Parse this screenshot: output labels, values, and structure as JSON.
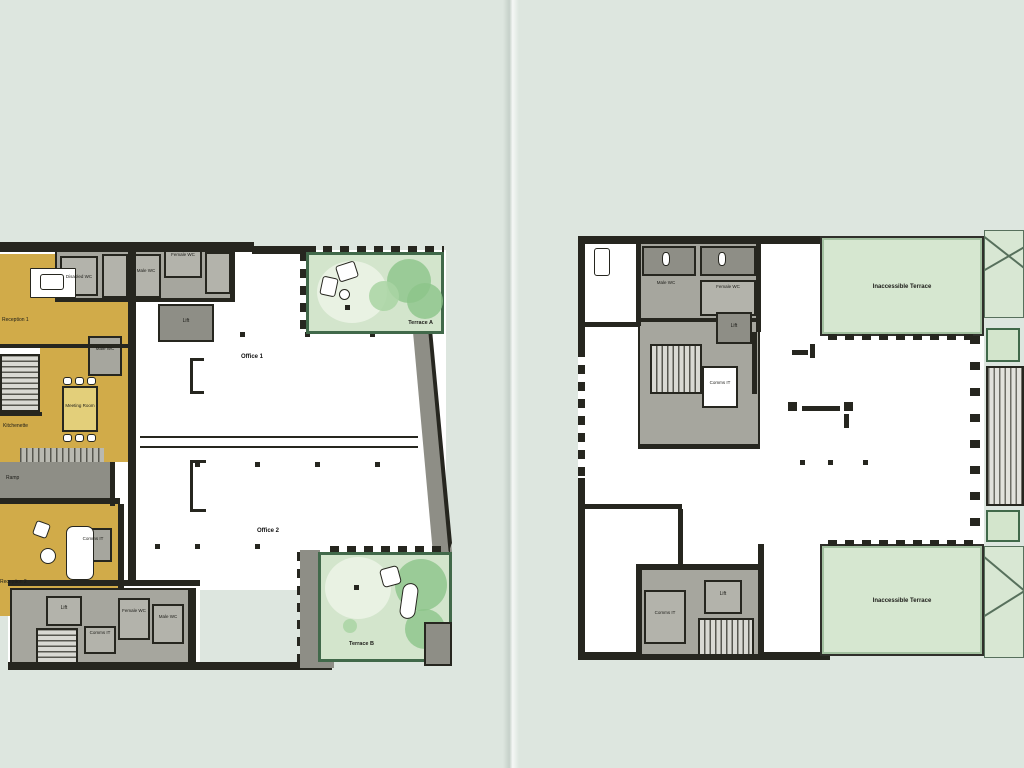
{
  "meta": {
    "description": "Two architectural floor plans side by side on a pale green background",
    "left_plan_name": "Lower floor plan",
    "right_plan_name": "Upper floor plan"
  },
  "colors": {
    "bg": "#dde6df",
    "ink": "#26261f",
    "yellow": "#d1ab49",
    "gray1": "#a6a69e",
    "gray2": "#8e8e86",
    "gray3": "#b3b3ab",
    "terr_fill": "#d3e5cc",
    "terr_light": "#e9f2e3",
    "tree": "#8cc489",
    "inacc_fill": "#d6e7d0",
    "green_border": "#41694a"
  },
  "left_plan": {
    "labels": {
      "reception1": "Reception 1",
      "disabled_wc": "Disabled WC",
      "male_wc_top": "Male WC",
      "female_wc_top": "Female WC",
      "male_wc_mid": "Male WC",
      "lift_mid": "Lift",
      "meeting_room": "Meeting Room",
      "kitchenette": "Kitchenette",
      "ramp": "Ramp",
      "comms_it_mid": "Comms IT",
      "reception2": "Reception 2",
      "lift_bottom": "Lift",
      "comms_it_bottom": "Comms IT",
      "female_wc_bottom": "Female WC",
      "male_wc_bottom": "Male WC",
      "office1": "Office 1",
      "office2": "Office 2",
      "terrace_a": "Terrace A",
      "terrace_b": "Terrace B"
    }
  },
  "right_plan": {
    "labels": {
      "male_wc": "Male WC",
      "female_wc": "Female WC",
      "lift_top": "Lift",
      "comms_it": "Comms IT",
      "comms_it_bottom": "Comms IT",
      "lift_bottom": "Lift",
      "inaccessible_terrace_top": "Inaccessible Terrace",
      "inaccessible_terrace_bottom": "Inaccessible Terrace"
    }
  }
}
